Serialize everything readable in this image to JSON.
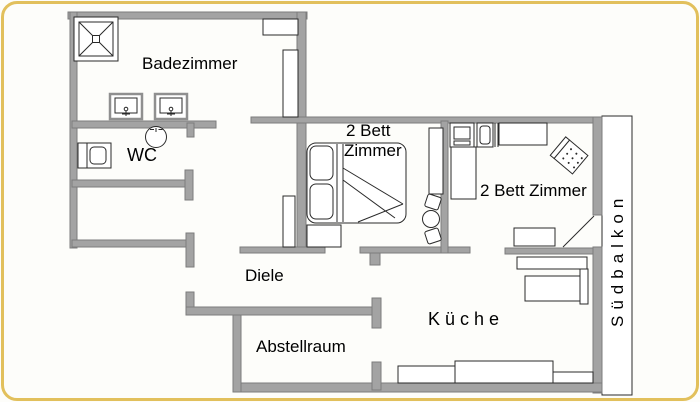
{
  "page": {
    "type": "apartment-floor-plan",
    "frame_color": "#e2c05c",
    "background": "#fdfdfa"
  },
  "colors": {
    "wall_fill": "#a3a3a3",
    "wall_edge": "#7c7c7c",
    "furniture_outline": "#2a2a2a",
    "text_color": "#000000",
    "frame_color": "#e2c05c"
  },
  "rooms": {
    "badezimmer": {
      "label": "Badezimmer"
    },
    "wc": {
      "label": "WC"
    },
    "bedroom_middle": {
      "label_line1": "2 Bett",
      "label_line2": "Zimmer"
    },
    "bedroom_right": {
      "label": "2 Bett Zimmer"
    },
    "diele": {
      "label": "Diele"
    },
    "abstellraum": {
      "label": "Abstellraum"
    },
    "kueche": {
      "label": "Küche"
    },
    "balkon": {
      "label": "Südbalkon"
    }
  }
}
